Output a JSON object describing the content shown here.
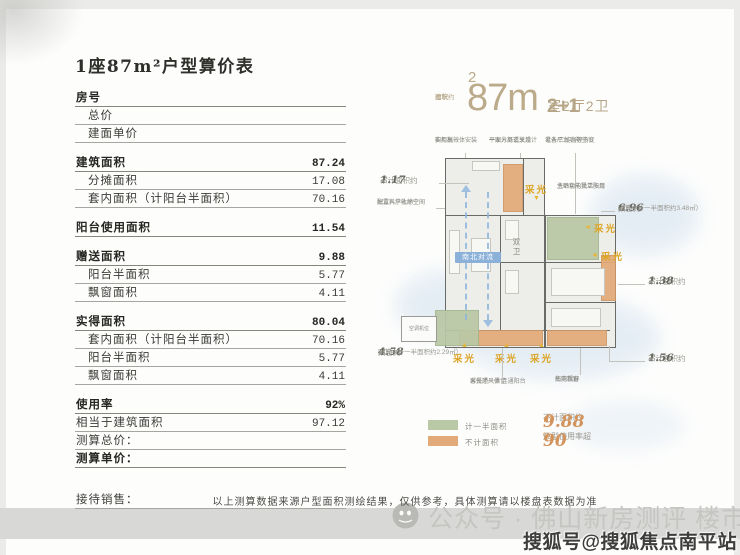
{
  "page": {
    "title": "1座87m²户型算价表",
    "disclaimer": "以上测算数据来源户型面积测绘结果，仅供参考，具体测算请以楼盘表数据为准",
    "watermark_wechat": "公众号 · 佛山新房测评 楼市吐槽",
    "watermark_sohu": "搜狐号@搜狐焦点南平站"
  },
  "price_table": {
    "rows": [
      {
        "label": "房号",
        "value": ""
      },
      {
        "label": "总价",
        "value": ""
      },
      {
        "label": "建面单价",
        "value": ""
      },
      {
        "label": "建筑面积",
        "value": "87.24"
      },
      {
        "label": "分摊面积",
        "value": "17.08"
      },
      {
        "label": "套内面积（计阳台半面积）",
        "value": "70.16"
      },
      {
        "label": "阳台使用面积",
        "value": "11.54"
      },
      {
        "label": "赠送面积",
        "value": "9.88"
      },
      {
        "label": "阳台半面积",
        "value": "5.77"
      },
      {
        "label": "飘窗面积",
        "value": "4.11"
      },
      {
        "label": "实得面积",
        "value": "80.04"
      },
      {
        "label": "套内面积（计阳台半面积）",
        "value": "70.16"
      },
      {
        "label": "阳台半面积",
        "value": "5.77"
      },
      {
        "label": "飘窗面积",
        "value": "4.11"
      },
      {
        "label": "使用率",
        "value": "92%"
      },
      {
        "label": "相当于建筑面积",
        "value": "97.12"
      },
      {
        "label": "测算总价：",
        "value": ""
      },
      {
        "label": "测算单价：",
        "value": ""
      },
      {
        "label": "接待销售：",
        "value": ""
      }
    ]
  },
  "floorplan": {
    "area_prefix_l1": "建筑",
    "area_prefix_l2": "面积约",
    "area_value": "87m",
    "area_sup": "2",
    "spec_num": "2+1",
    "spec_rest": "室2厅2卫",
    "daylight": "采光",
    "dual_bath": "双卫",
    "wind_label": "南北对流",
    "ac_label": "空调机位",
    "callouts": {
      "top1_l1": "橱柜板一体安装",
      "top1_l2": "实用高效",
      "top2_l1": "平面分离玄关设计",
      "top2_l2": "一家人舒适享用",
      "top3_l1": "设备平台功能空间",
      "top3_l2": "老人/二娃房等多变",
      "right_top_l1": "主卧套内独立阳台",
      "right_top_l2": "洗晒功能灵活多用",
      "left_entry_l1": "独立入户礼序空间",
      "left_entry_l2": "配置科学收纳空间",
      "bottom1_l1": "客餐厅一体 连通阳台",
      "bottom1_l2": "采光通风俱佳",
      "bottom2_l1": "南向飘窗",
      "bottom2_l2": "拓宽视野",
      "m117_prefix": "不计面积约",
      "m117_num": "1.17",
      "m117_unit": "㎡",
      "m696_prefix": "阳台约",
      "m696_num": "6.96",
      "m696_unit": "㎡",
      "m696_sub": "（其中计一半面积约3.48㎡）",
      "m138_prefix": "不计面积约",
      "m138_num": "1.38",
      "m138_unit": "㎡",
      "m156_prefix": "不计面积约",
      "m156_num": "1.56",
      "m156_unit": "㎡",
      "m458_prefix": "阳台约",
      "m458_num": "4.58",
      "m458_unit": "㎡",
      "m458_sub": "（其中计一半面积约2.29㎡）"
    },
    "legend": {
      "half_label": "计一半面积",
      "none_label": "不计面积",
      "stat1_prefix": "不计面积约",
      "stat1_num": "9.88",
      "stat1_unit": "㎡",
      "stat2_prefix": "户型使用率超",
      "stat2_num": "90",
      "stat2_unit": "%"
    }
  },
  "colors": {
    "accent_tan": "#b6a687",
    "daylight_yellow": "#dca526",
    "half_area_green": "#b9c8a5",
    "no_area_orange": "#e3aa79",
    "wind_blue": "#86aed8",
    "stat_orange": "#d2945c"
  }
}
